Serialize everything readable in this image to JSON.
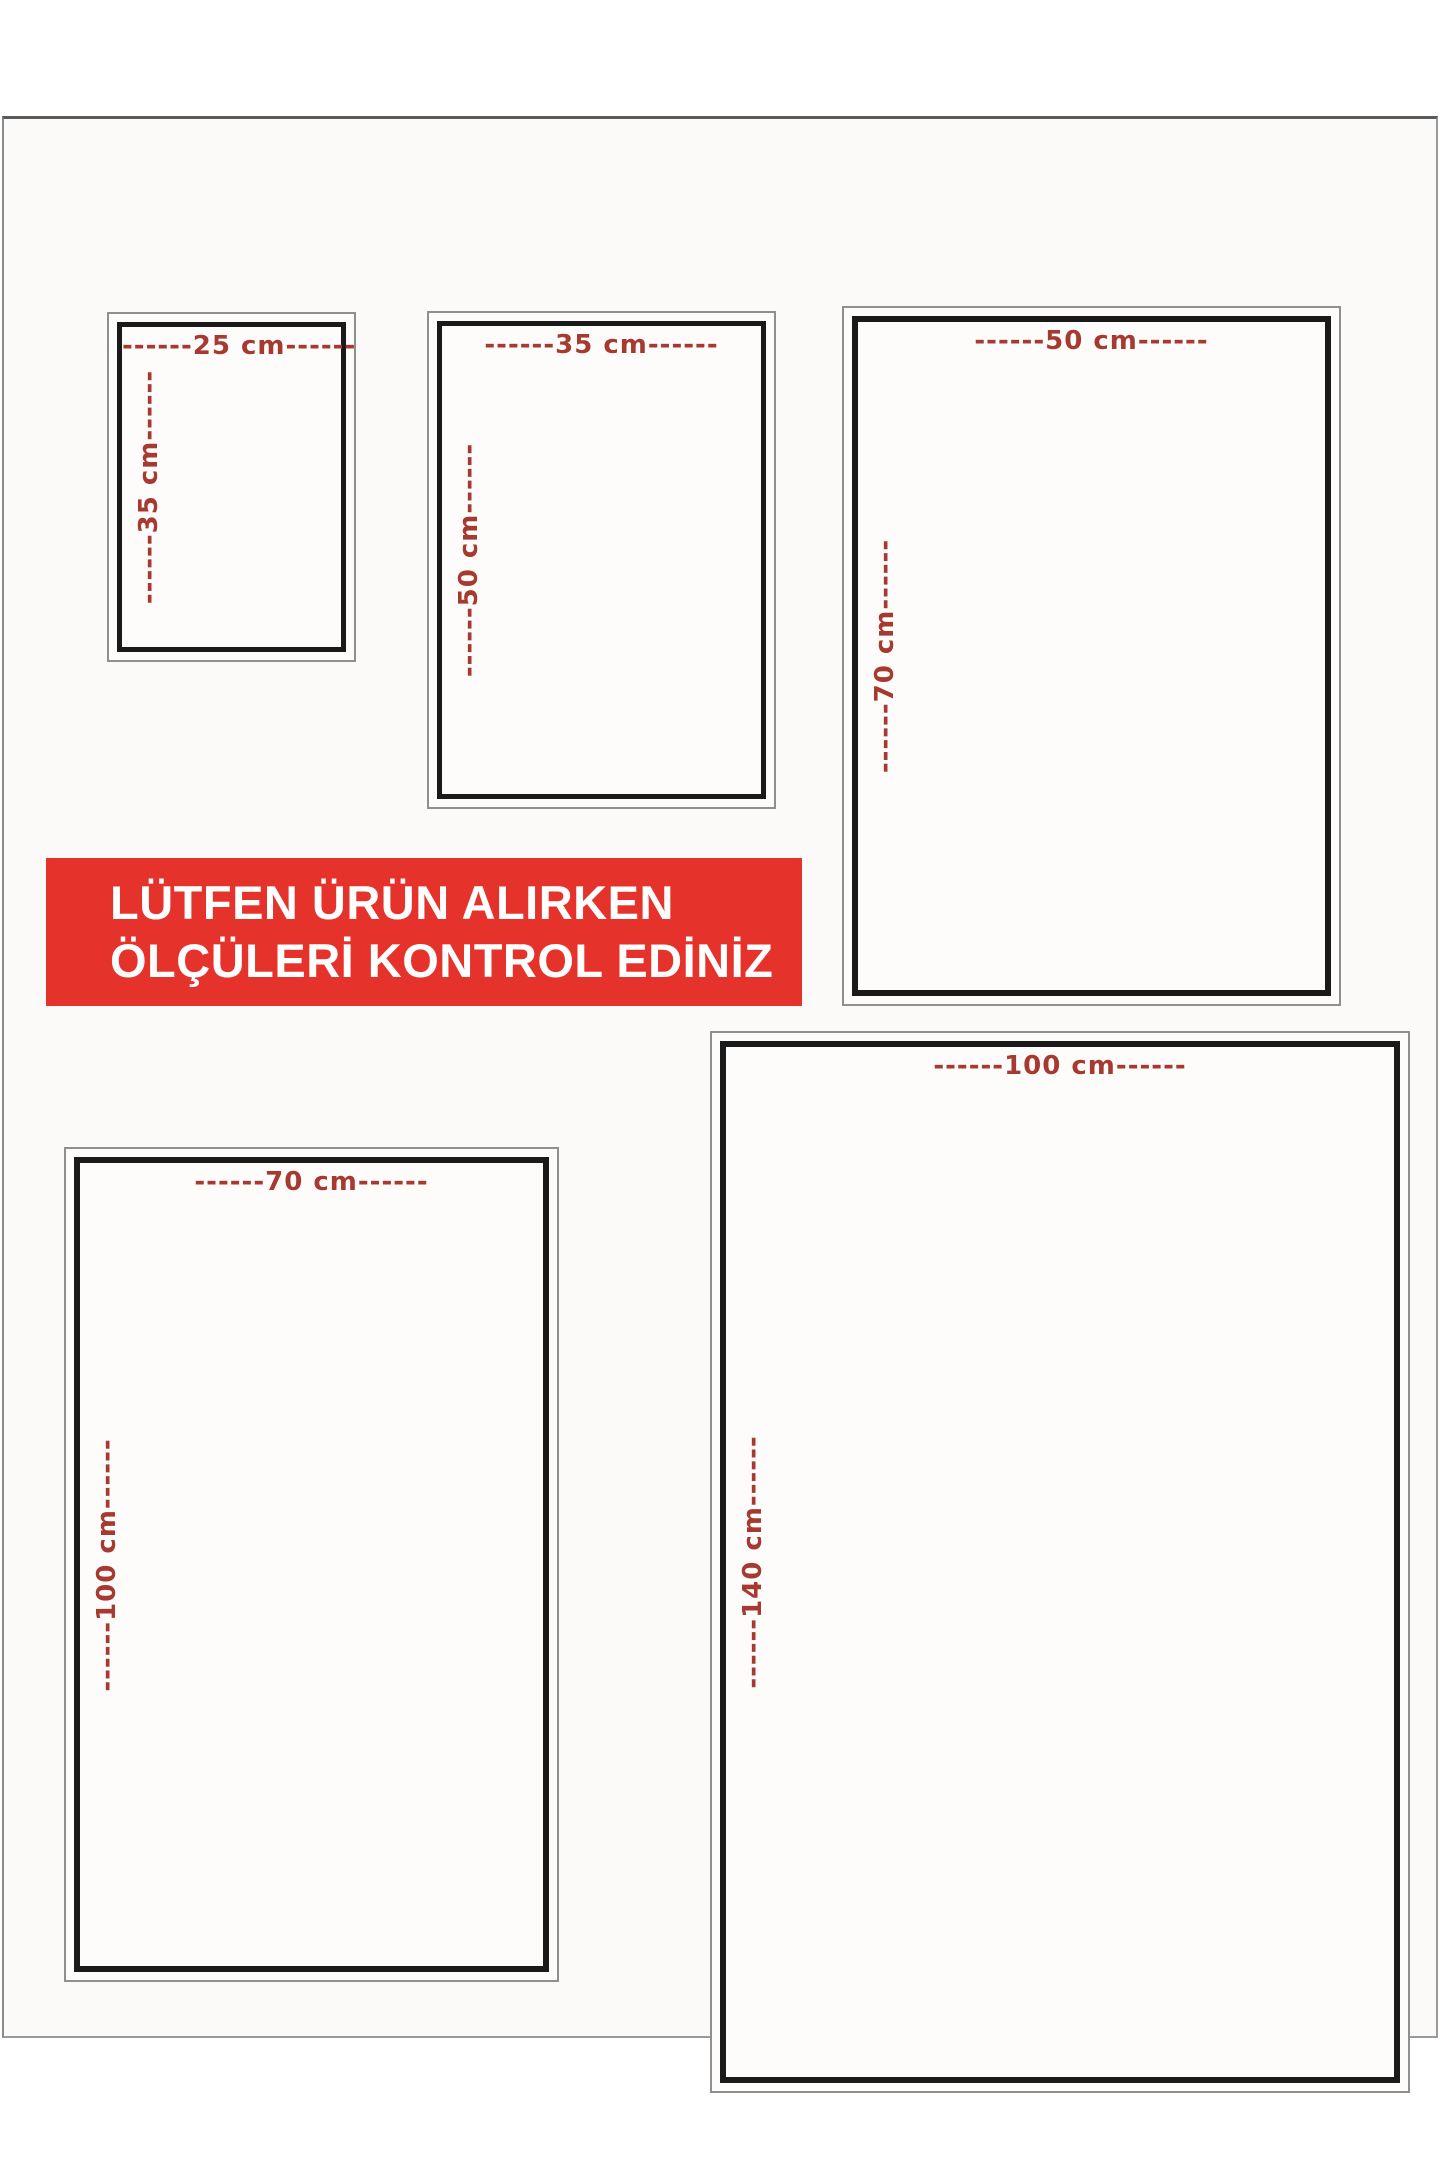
{
  "page": {
    "type": "product-size-chart"
  },
  "banner": {
    "line1": "LÜTFEN ÜRÜN ALIRKEN",
    "line2": "ÖLÇÜLERİ KONTROL EDİNİZ"
  },
  "sizes": [
    {
      "name": "25x35 cm",
      "width_cm": 25,
      "height_cm": 35,
      "width_label": "------25 cm------",
      "height_label": "------35 cm------"
    },
    {
      "name": "35x50 cm",
      "width_cm": 35,
      "height_cm": 50,
      "width_label": "------35 cm------",
      "height_label": "------50 cm------"
    },
    {
      "name": "50x70 cm",
      "width_cm": 50,
      "height_cm": 70,
      "width_label": "------50 cm------",
      "height_label": "------70 cm------"
    },
    {
      "name": "70x100 cm",
      "width_cm": 70,
      "height_cm": 100,
      "width_label": "------70 cm------",
      "height_label": "------100 cm------"
    },
    {
      "name": "100x140 cm",
      "width_cm": 100,
      "height_cm": 140,
      "width_label": "------100 cm------",
      "height_label": "------140 cm------"
    }
  ],
  "colors": {
    "banner_bg": "#e5322b",
    "banner_text": "#ffffff",
    "dimension_text": "#a63a31",
    "frame_black": "#1a1a1a",
    "frame_gray": "#8f8f8f",
    "photo_bg": "#fbfaf8",
    "photo_edge": "#5a5a5a"
  }
}
